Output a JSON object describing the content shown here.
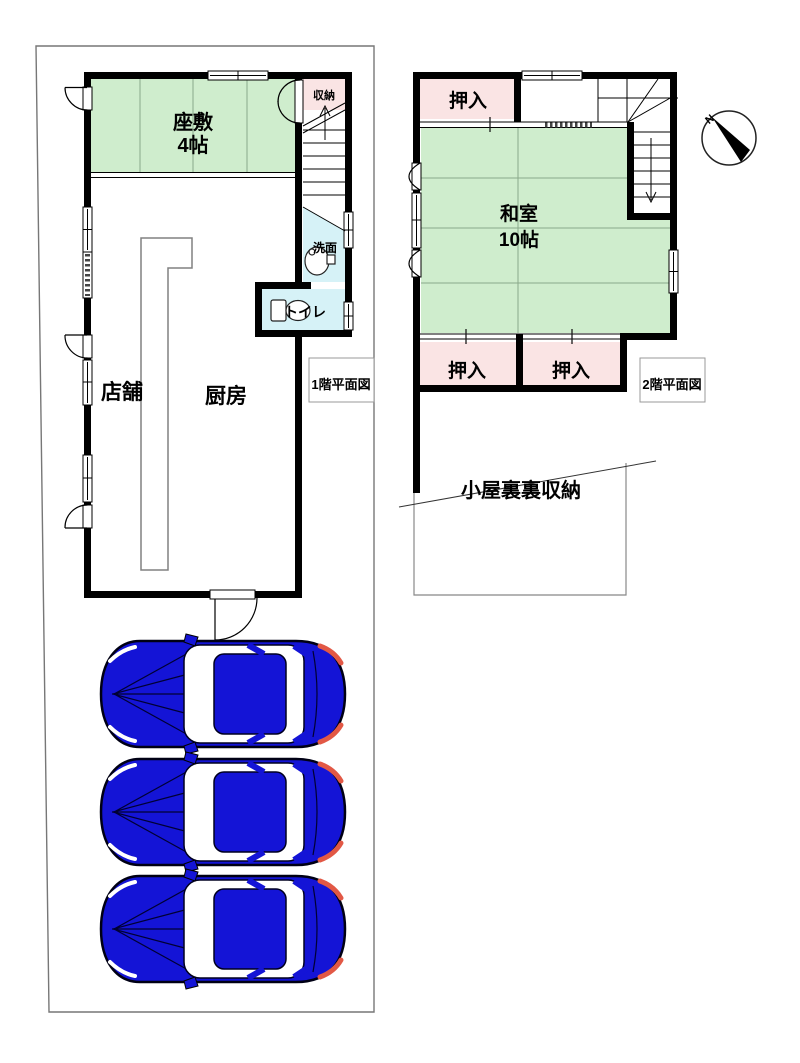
{
  "colors": {
    "room_green": "#CFEDCD",
    "room_pink": "#FAE4E4",
    "room_cyan": "#D6F2F7",
    "car_blue": "#1414D6",
    "tail_light": "#E25845",
    "wall_black": "#000000"
  },
  "first_floor": {
    "caption": "1階平面図",
    "zashiki": {
      "name": "座敷",
      "size": "4帖"
    },
    "storage_label": "収納",
    "washroom_label": "洗面",
    "toilet_label": "トイレ",
    "shop_label": "店舗",
    "kitchen_label": "厨房"
  },
  "second_floor": {
    "caption": "2階平面図",
    "washitsu": {
      "name": "和室",
      "size": "10帖"
    },
    "closet_top_label": "押入",
    "closet_bottom_left_label": "押入",
    "closet_bottom_right_label": "押入",
    "attic_label": "小屋裏裏収納"
  },
  "compass": {
    "north": "N"
  }
}
